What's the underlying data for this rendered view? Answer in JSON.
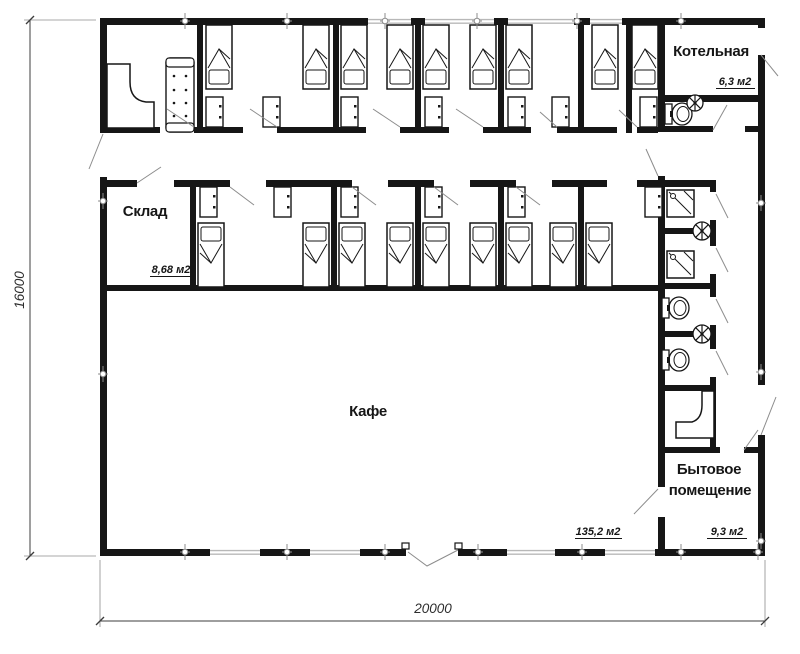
{
  "plan": {
    "rooms": {
      "boiler_room": {
        "label": "Котельная",
        "area": "6,3 м2"
      },
      "storage": {
        "label": "Склад",
        "area": "8,68 м2"
      },
      "cafe": {
        "label": "Кафе",
        "area": "135,2 м2"
      },
      "utility_room": {
        "label_line1": "Бытовое",
        "label_line2": "помещение",
        "area": "9,3 м2"
      }
    },
    "dimensions": {
      "height_mm": "16000",
      "width_mm": "20000"
    }
  },
  "colors": {
    "wall": "#161616",
    "window": "#b8b8b8",
    "door_line": "#8c8c8c",
    "marker": "#8c8c8c",
    "dimension": "#3c3c3c",
    "background": "#ffffff"
  }
}
